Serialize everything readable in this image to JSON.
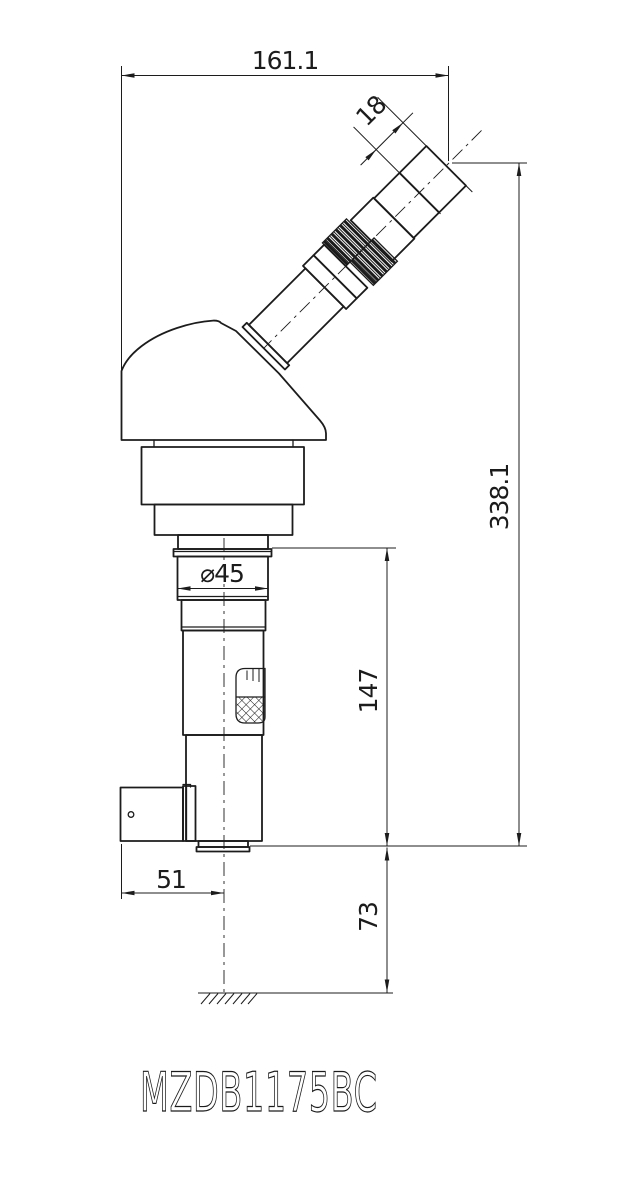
{
  "drawing": {
    "part_number": "MZDB1175BC"
  },
  "dimensions": {
    "overall_width": "161.1",
    "eyepiece_tip_length": "18",
    "total_height": "338.1",
    "mount_diameter": "⌀45",
    "lower_body_height": "147",
    "axis_offset": "51",
    "ground_clearance": "73"
  },
  "colors": {
    "line": "#1c1c1c",
    "background": "#ffffff"
  }
}
